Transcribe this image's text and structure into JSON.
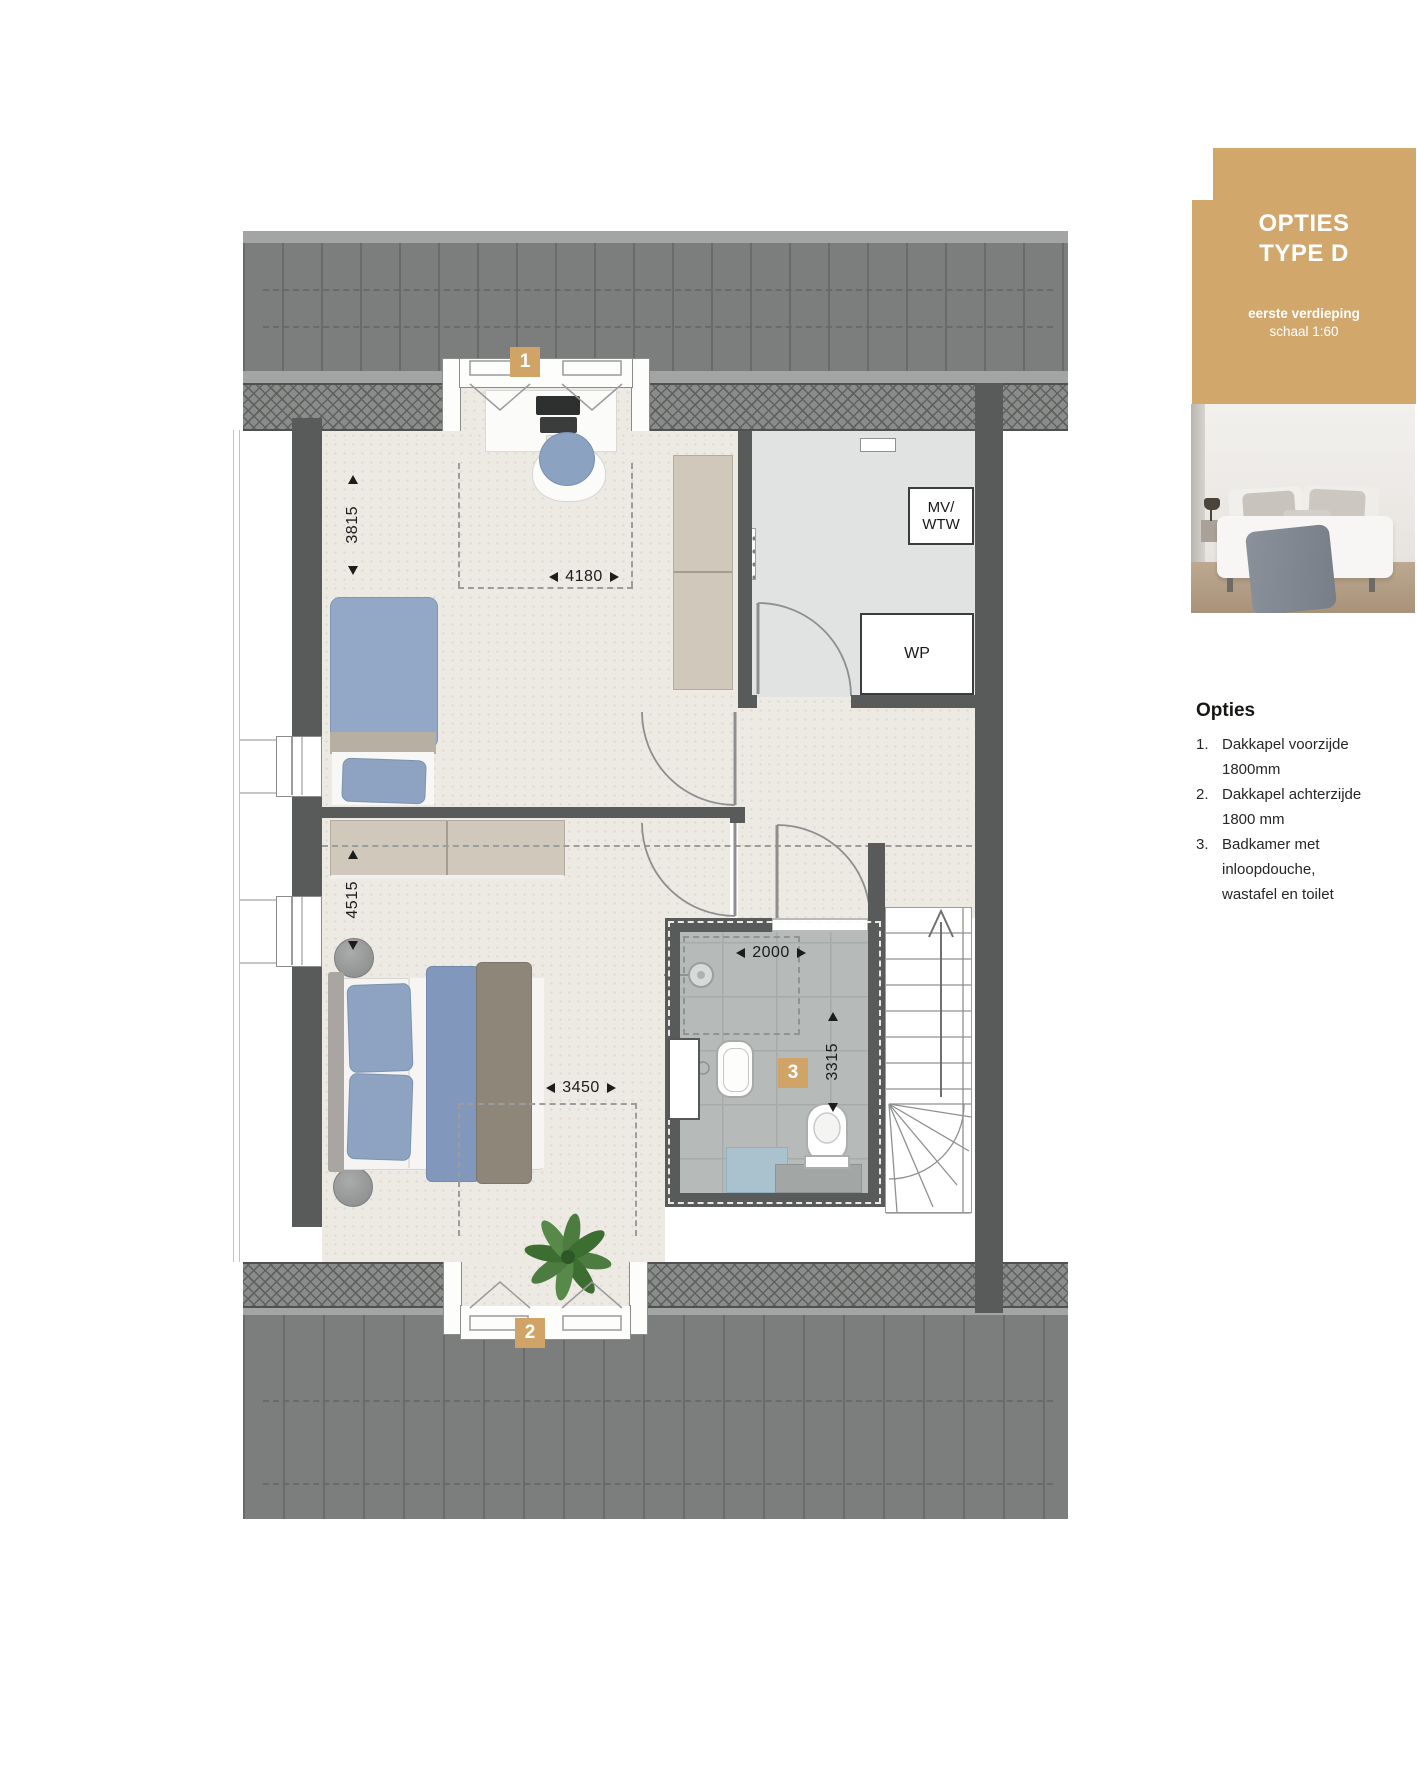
{
  "header_card": {
    "title_line1": "OPTIES",
    "title_line2": "TYPE D",
    "subtitle_bold": "eerste verdieping",
    "subtitle": "schaal 1:60"
  },
  "options_panel": {
    "heading": "Opties",
    "items": [
      {
        "num": "1.",
        "lines": [
          "Dakkapel voorzijde",
          "1800mm"
        ]
      },
      {
        "num": "2.",
        "lines": [
          "Dakkapel achterzijde",
          "1800 mm"
        ]
      },
      {
        "num": "3.",
        "lines": [
          "Badkamer met",
          "inloopdouche,",
          "wastafel en toilet"
        ]
      }
    ]
  },
  "floorplan": {
    "badges": {
      "dormer_front": "1",
      "dormer_back": "2",
      "bathroom": "3"
    },
    "labels": {
      "mv_wtw_line1": "MV/",
      "mv_wtw_line2": "WTW",
      "wp": "WP"
    },
    "dimensions": {
      "bedroom1_depth": "3815",
      "bedroom1_width": "4180",
      "bedroom2_depth": "4515",
      "bedroom2_width": "3450",
      "bathroom_width": "2000",
      "bathroom_depth": "3315"
    }
  },
  "colors": {
    "accent_tan": "#d1a76c",
    "badge_tan": "#d0a466",
    "wall_gray": "#585b5a",
    "roof_gray": "#7c7e7d",
    "floor_beige": "#edeae4",
    "tech_floor_gray": "#e1e3e2",
    "tile_gray": "#b6bab9"
  }
}
